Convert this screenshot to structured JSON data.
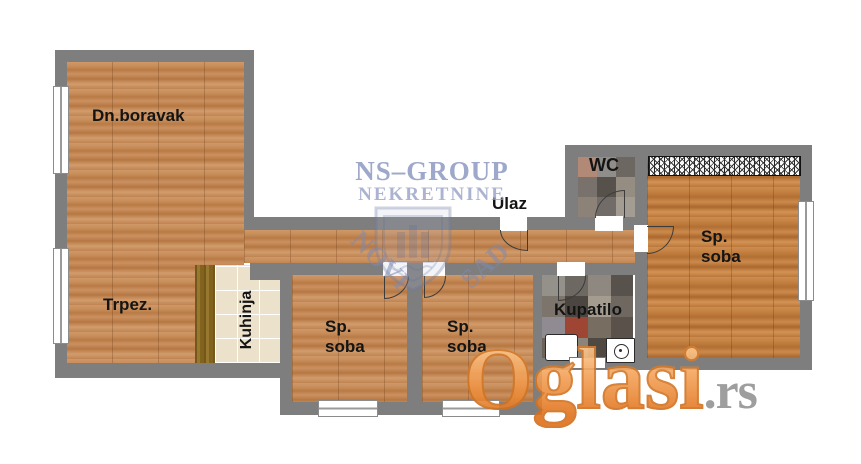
{
  "plan_title": "apartment-floor-plan",
  "rooms": {
    "living": {
      "label": "Dn.boravak"
    },
    "dining": {
      "label": "Trpez."
    },
    "kitchen": {
      "label": "Kuhinja"
    },
    "bedroom_small_1": {
      "line1": "Sp.",
      "line2": "soba"
    },
    "bedroom_small_2": {
      "line1": "Sp.",
      "line2": "soba"
    },
    "bedroom_main": {
      "line1": "Sp.",
      "line2": "soba"
    },
    "bathroom": {
      "label": "Kupatilo"
    },
    "wc": {
      "label": "WC"
    },
    "entrance": {
      "label": "Ulaz"
    }
  },
  "watermarks": {
    "agency_name": "NS–GROUP",
    "agency_subtitle": "NEKRETNINE",
    "emblem_word_left": "NOVI",
    "emblem_word_right": "SAD",
    "site_name": "Oglasi",
    "site_domain": ".rs"
  },
  "icons": {
    "door_swing": "quarter-arc",
    "window": "double-line-rect",
    "wardrobe": "hatched-rect",
    "washing_machine": "square-with-drum-circle",
    "city_emblem": "shield-with-building"
  },
  "colors": {
    "wall": "#7e7e7e",
    "wood_floor": "#c48a58",
    "wood_floor_warm": "#bd7a3e",
    "kitchen_tile": "#ece2cc",
    "kitchen_counter": "#866822",
    "label_text": "#141414",
    "agency_watermark": "#919cc3",
    "site_watermark_top": "#fdd6a4",
    "site_watermark_bottom": "#e0711a",
    "site_domain_gray": "#949494"
  }
}
